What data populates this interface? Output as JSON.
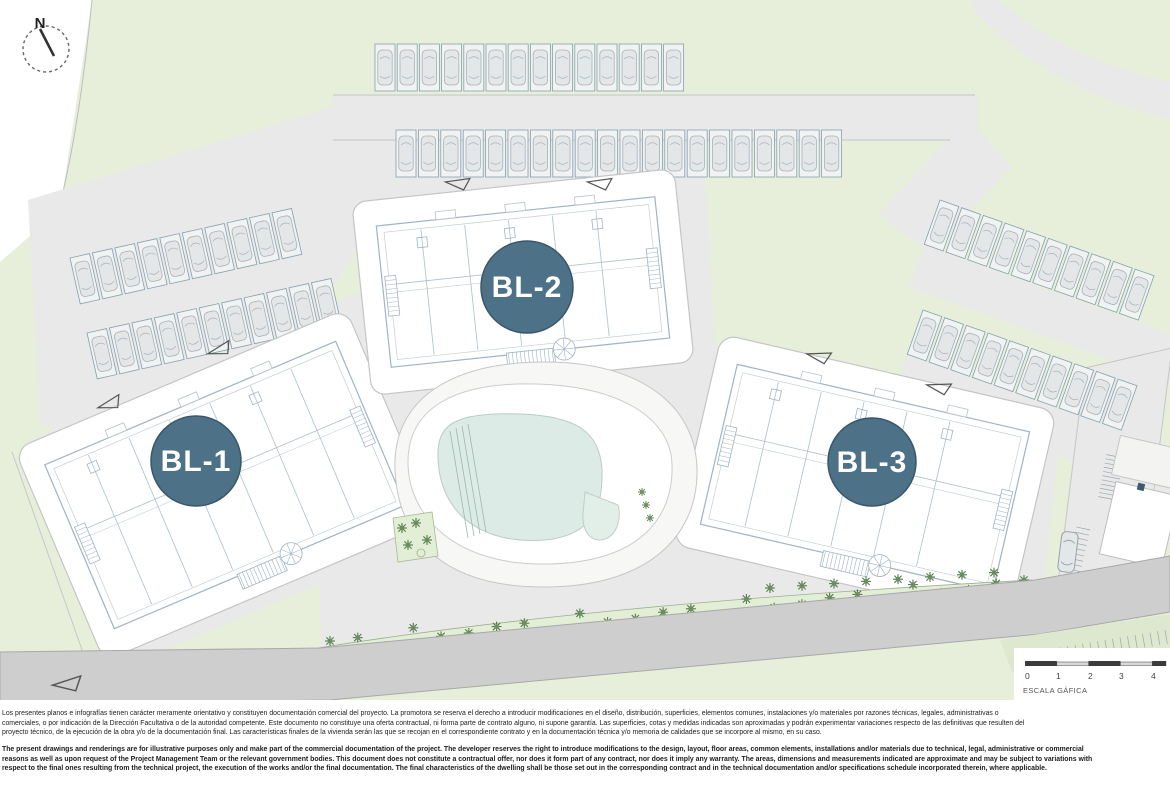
{
  "compass": {
    "label": "N"
  },
  "buildings": [
    {
      "label": "BL-1"
    },
    {
      "label": "BL-2"
    },
    {
      "label": "BL-3"
    }
  ],
  "scalebar": {
    "label": "ESCALA GÁFICA",
    "ticks": [
      "0",
      "1",
      "2",
      "3",
      "4"
    ]
  },
  "colors": {
    "badge": "#4d7187",
    "green": "#e7efdb",
    "green_strip": "#e3eed6",
    "road": "#e9e9e9",
    "road_dark": "#cecece",
    "water": "#dcebe5",
    "tree": "#5e8453",
    "building_line": "#9fb4c2"
  },
  "disclaimer": {
    "es_lines": [
      "Los presentes planos e infografías tienen carácter meramente orientativo y constituyen documentación comercial del proyecto. La promotora se reserva el derecho a introducir modificaciones en el diseño, distribución, superficies, elementos comunes, instalaciones y/o materiales por razones técnicas, legales, administrativas o",
      "comerciales, o por indicación de la Dirección Facultativa o de la autoridad competente. Este documento no constituye una oferta contractual, ni forma parte de contrato alguno, ni supone garantía. Las superficies, cotas y medidas indicadas son aproximadas y podrán experimentar variaciones respecto de las definitivas que resulten del",
      "proyecto técnico, de la ejecución de la obra y/o de la documentación final. Las características finales de la vivienda serán las que se recojan en el correspondiente contrato y en la documentación técnica y/o memoria de calidades que se incorpore al mismo, en su caso."
    ],
    "en_lines": [
      "The present drawings and renderings are for illustrative purposes only and make part of the commercial documentation of the project. The developer reserves the right to introduce modifications to the design, layout, floor areas, common elements, installations and/or materials due to technical, legal, administrative or commercial",
      "reasons as well as upon request of the Project Management Team or the relevant government bodies. This document does not constitute a contractual offer, nor does it form part of any contract, nor does it imply any warranty. The areas, dimensions and measurements indicated are approximate and may be subject to variations with",
      "respect to the final ones resulting from the technical project, the execution of the works and/or the final documentation. The final characteristics of the dwelling shall be those set out in the corresponding contract and in the technical documentation and/or specifications schedule incorporated therein, where applicable."
    ]
  }
}
